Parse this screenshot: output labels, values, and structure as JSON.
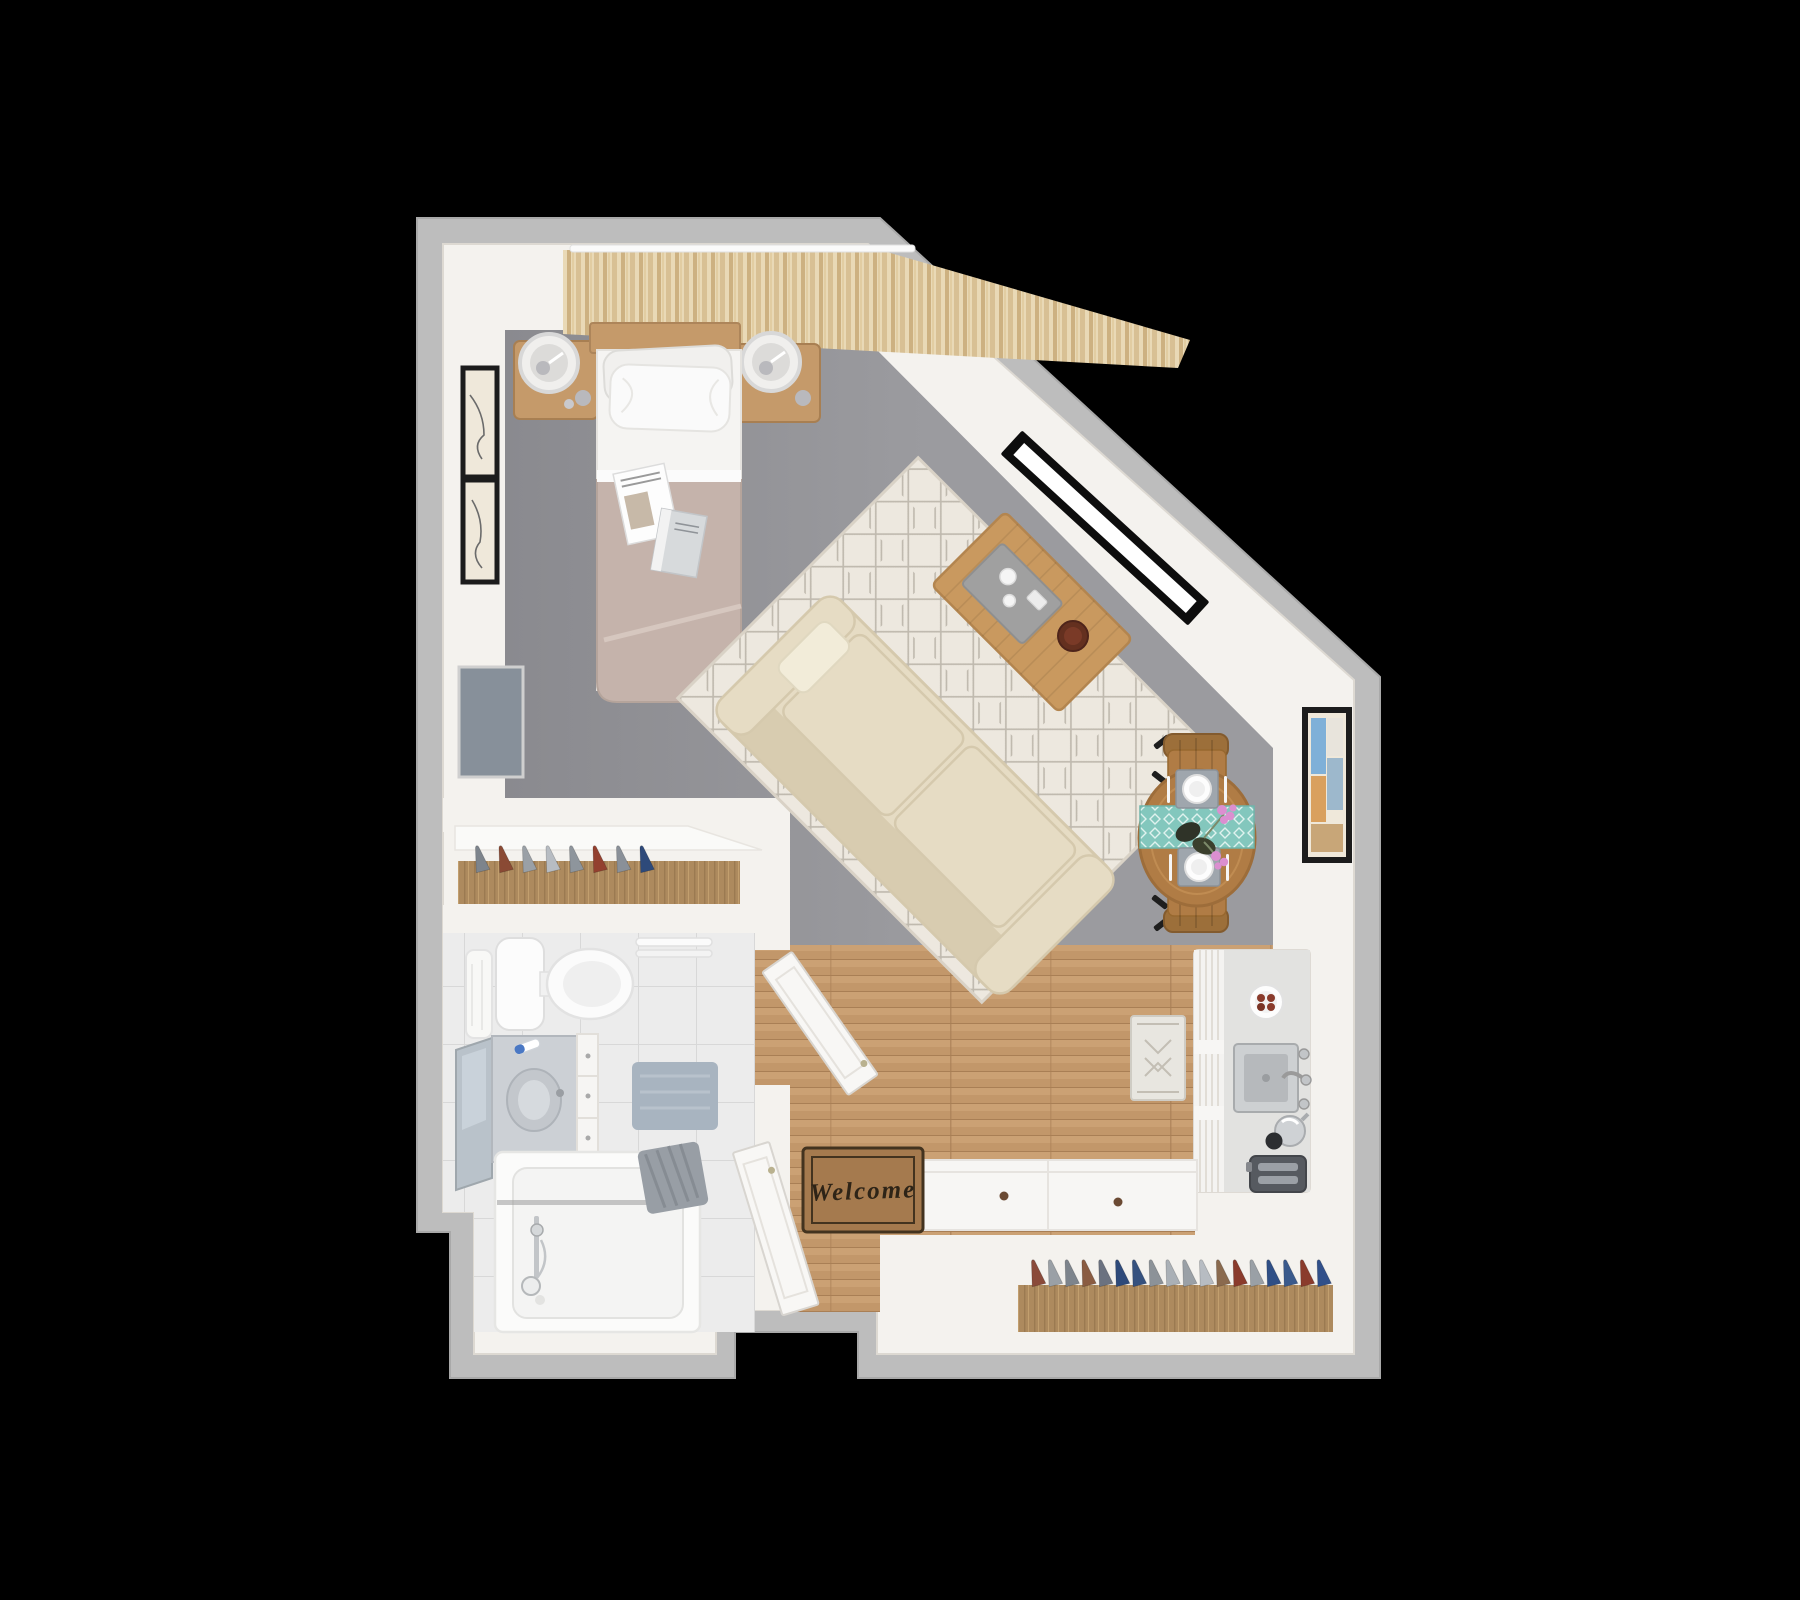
{
  "entry": {
    "welcome_mat": {
      "text": "Welcome"
    }
  },
  "closets": {
    "small": {
      "hangers": [
        "#7d848c",
        "#8a4a34",
        "#9aa0a6",
        "#b7bcc2",
        "#8e959c",
        "#93402f",
        "#8a9098",
        "#2e4a7a"
      ]
    },
    "large": {
      "hangers": [
        "#8a4a3a",
        "#9aa0a6",
        "#7d848c",
        "#8a5c42",
        "#6b7280",
        "#2e4a7a",
        "#36527f",
        "#8c9298",
        "#aab0b6",
        "#9aa0a6",
        "#b7bcc2",
        "#8a6a4e",
        "#8a3b2c",
        "#9aa0a6",
        "#2f4f86",
        "#3a5a8c",
        "#8a3b2c",
        "#31508a"
      ]
    }
  },
  "colors": {
    "background": "#000000",
    "outer_wall": "#bdbdbd",
    "outer_wall_edge": "#a9a9a9",
    "wall": "#f4f2ee",
    "wall_edge": "#ddd9d2",
    "carpet": "#9b9b9f",
    "carpet_dark": "#8a8a8f",
    "wood_light": "#d2a97c",
    "wood_mid": "#c2976a",
    "wood_dark": "#a97f55",
    "tile": "#ececec",
    "tile_line": "#d8d8d8",
    "rug": "#ede8df",
    "rug_line": "#bfb9ae",
    "sofa": "#e6dcc4",
    "sofa_shade": "#d5c9ad",
    "table_wood": "#c9995f",
    "tray": "#a0a0a0",
    "bowl": "#64301f",
    "bed_blanket": "#c5b3ab",
    "bed_sheet": "#f5f4f2",
    "pillow": "#fafafa",
    "furniture_wood": "#c59a6a",
    "rail_wood": "#ad8a5e",
    "dining_wood": "#b07c45",
    "chair_wood": "#9c6f3a",
    "runner_teal": "#83c7bd",
    "placemat": "#9fa6ad",
    "mat_brown": "#a57a4e",
    "mat_border": "#43331f",
    "mat_text": "#2e2417",
    "door": "#f8f7f5",
    "tv": "#87909a",
    "frame_black": "#1c1c1c",
    "art_cream": "#efe8da",
    "window_frame": "#0d0d0d",
    "glass": "#ffffff",
    "bath_mat": "#a8b4c0",
    "towel": "#989ea5",
    "marble": "#ccd0d5",
    "mirror": "#b9c2ca",
    "steel": "#c2c5c8",
    "toaster": "#565a60",
    "kitchen_unit": "#ededeb",
    "counter": "#e2e2e0",
    "cookie": "#8a3b2c",
    "flower_pink": "#db8fd0",
    "vase_dark": "#2f3328"
  }
}
